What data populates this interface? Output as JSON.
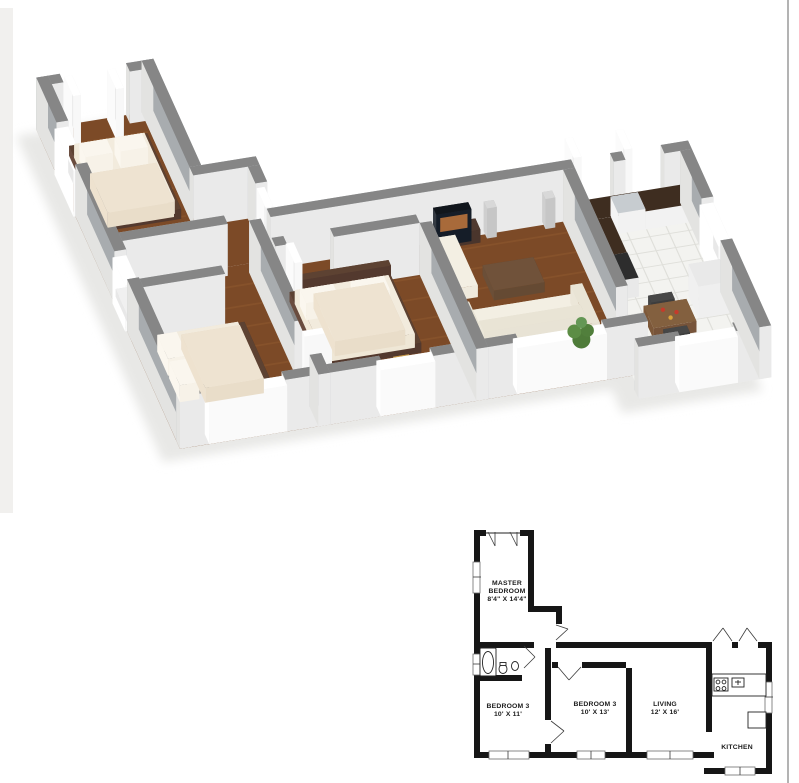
{
  "page": {
    "background": "#ffffff"
  },
  "floor_plan_3d": {
    "colors": {
      "wood_floor": "#7c4a27",
      "wood_streak": "#9a6234",
      "wall_top": "#868686",
      "wall_face_bright": "#eaeaea",
      "wall_face_inner": "#a8acaf",
      "kitchen_tile": "#f3f3f0",
      "bath_tile": "#d9dbdc",
      "bed_linen": "#f2ebdd",
      "bed_frame": "#53392e",
      "sofa": "#efeadd",
      "coffee_table": "#6b4f38",
      "counter_top": "#3e2d20",
      "plant": "#4e7b39",
      "table_accent_red": "#c43b2b",
      "table_accent_gold": "#d9a23a",
      "tv_screen": "#a86a3a"
    }
  },
  "floor_plan_2d": {
    "wall_color": "#161616",
    "rooms": [
      {
        "id": "master-bedroom",
        "lines": [
          "MASTER",
          "BEDROOM",
          "8'4\" X 14'4\""
        ]
      },
      {
        "id": "bedroom-3a",
        "lines": [
          "BEDROOM 3",
          "10' X 11'"
        ]
      },
      {
        "id": "bedroom-3b",
        "lines": [
          "BEDROOM 3",
          "10' X 13'"
        ]
      },
      {
        "id": "living",
        "lines": [
          "LIVING",
          "12' X 16'"
        ]
      },
      {
        "id": "kitchen",
        "lines": [
          "KITCHEN"
        ]
      }
    ]
  }
}
